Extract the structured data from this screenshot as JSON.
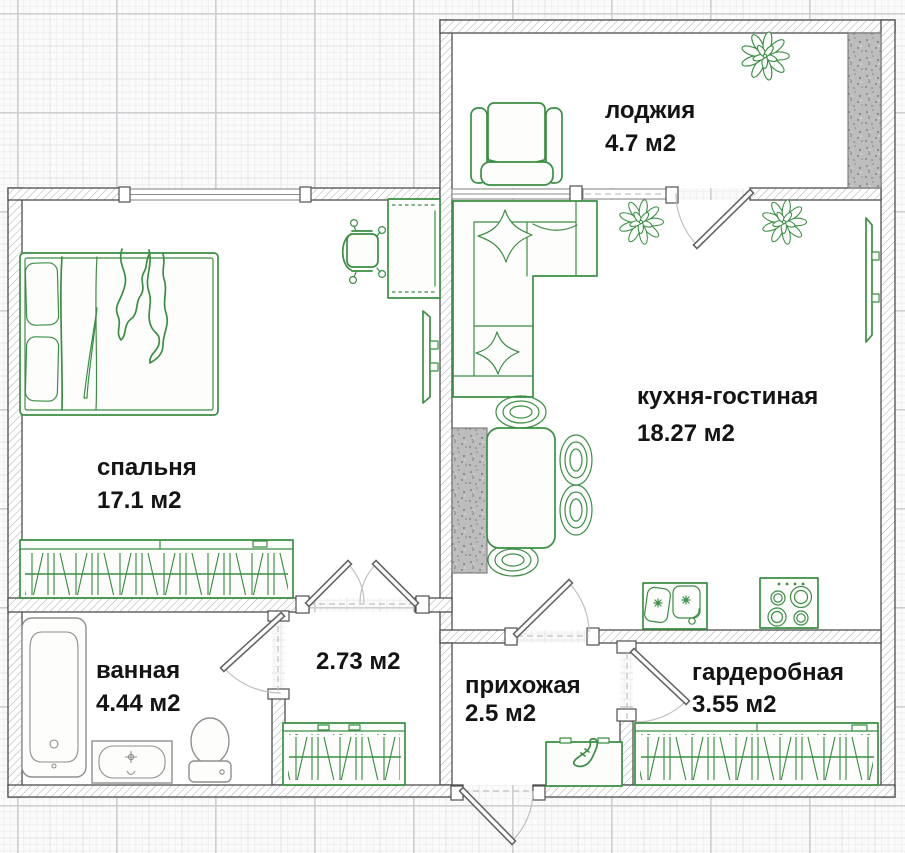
{
  "title": "apartment-floor-plan",
  "rooms": {
    "loggia": {
      "name": "лоджия",
      "area": "4.7 м2"
    },
    "kitchen_living": {
      "name": "кухня-гостиная",
      "area": "18.27 м2"
    },
    "bedroom": {
      "name": "спальня",
      "area": "17.1 м2"
    },
    "bathroom": {
      "name": "ванная",
      "area": "4.44 м2"
    },
    "closet": {
      "name": "",
      "area": "2.73 м2"
    },
    "hallway": {
      "name": "прихожая",
      "area": "2.5 м2"
    },
    "wardrobe_room": {
      "name": "гардеробная",
      "area": "3.55 м2"
    }
  },
  "colors": {
    "green": "#3a8f43",
    "wall": "#4f4f4f",
    "hatch": "#a9a9a9",
    "fixture": "#8f8f8f",
    "doorDark": "#636363",
    "arcGray": "#c0c0c0",
    "label": "#141414",
    "bg": "#fafafa",
    "floor": "#ffffff",
    "gridMinor": "#f0f0f2",
    "gridMedium": "#e4e4e7",
    "gridMajor": "#cfcfd3",
    "speckBg": "#bdbdbd",
    "speckDot": "#868686"
  }
}
